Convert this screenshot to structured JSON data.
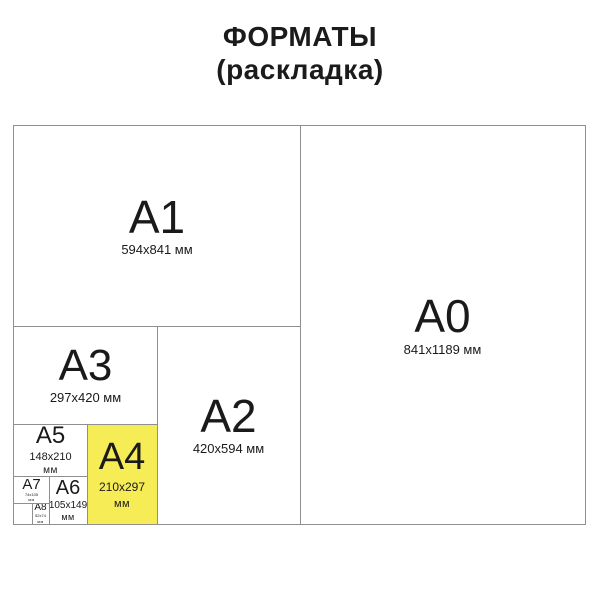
{
  "title": {
    "line1": "ФОРМАТЫ",
    "line2": "(раскладка)"
  },
  "colors": {
    "highlight_fill": "#F6EC55",
    "line": "#8F8F8F",
    "text": "#1A1A1A"
  },
  "diagram": {
    "a0": {
      "name": "A0",
      "size": "841x1189 мм"
    },
    "a1": {
      "name": "A1",
      "size": "594x841 мм"
    },
    "a2": {
      "name": "A2",
      "size": "420x594 мм"
    },
    "a3": {
      "name": "A3",
      "size": "297x420 мм"
    },
    "a4": {
      "name": "A4",
      "size": "210x297",
      "unit": "мм",
      "highlighted": true
    },
    "a5": {
      "name": "A5",
      "size": "148x210",
      "unit": "мм"
    },
    "a6": {
      "name": "A6",
      "size": "105x149",
      "unit": "мм"
    },
    "a7": {
      "name": "A7",
      "size": "74x105",
      "unit": "мм"
    },
    "a8": {
      "name": "A8",
      "size": "52x74",
      "unit": "мм"
    }
  }
}
